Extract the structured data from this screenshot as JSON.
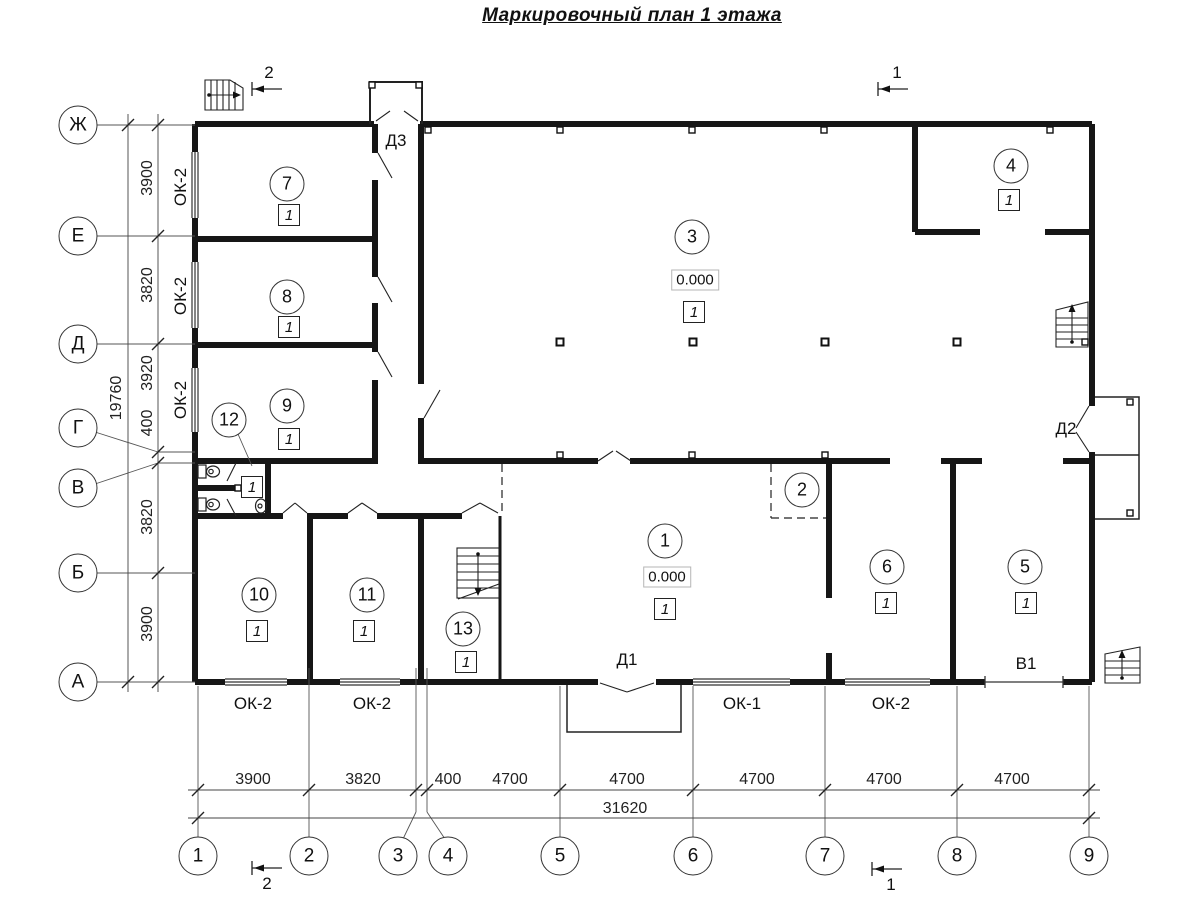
{
  "title": "Маркировочный план 1 этажа",
  "axes": {
    "rows": [
      {
        "label": "Ж"
      },
      {
        "label": "Е"
      },
      {
        "label": "Д"
      },
      {
        "label": "Г"
      },
      {
        "label": "В"
      },
      {
        "label": "Б"
      },
      {
        "label": "А"
      }
    ],
    "cols": [
      {
        "label": "1"
      },
      {
        "label": "2"
      },
      {
        "label": "3"
      },
      {
        "label": "4"
      },
      {
        "label": "5"
      },
      {
        "label": "6"
      },
      {
        "label": "7"
      },
      {
        "label": "8"
      },
      {
        "label": "9"
      }
    ]
  },
  "dims": {
    "left_overall": "19760",
    "left_segments": [
      "3900",
      "3820",
      "3920",
      "400",
      "3820",
      "3900"
    ],
    "bottom_segments": [
      "3900",
      "3820",
      "400",
      "4700",
      "4700",
      "4700",
      "4700",
      "4700"
    ],
    "bottom_overall": "31620"
  },
  "sections": {
    "cut1": "1",
    "cut2": "2"
  },
  "rooms": [
    {
      "num": "1",
      "cat": "1",
      "elev": "0.000"
    },
    {
      "num": "2"
    },
    {
      "num": "3",
      "cat": "1",
      "elev": "0.000"
    },
    {
      "num": "4",
      "cat": "1"
    },
    {
      "num": "5",
      "cat": "1"
    },
    {
      "num": "6",
      "cat": "1"
    },
    {
      "num": "7",
      "cat": "1"
    },
    {
      "num": "8",
      "cat": "1"
    },
    {
      "num": "9",
      "cat": "1"
    },
    {
      "num": "10",
      "cat": "1"
    },
    {
      "num": "11",
      "cat": "1"
    },
    {
      "num": "12",
      "cat": "1"
    },
    {
      "num": "13",
      "cat": "1"
    }
  ],
  "marks": {
    "doors": [
      "Д1",
      "Д2",
      "Д3"
    ],
    "windows_left": [
      "ОК-2",
      "ОК-2",
      "ОК-2"
    ],
    "windows_bottom": [
      "ОК-2",
      "ОК-2",
      "ОК-1",
      "ОК-2"
    ],
    "gate": "В1"
  }
}
